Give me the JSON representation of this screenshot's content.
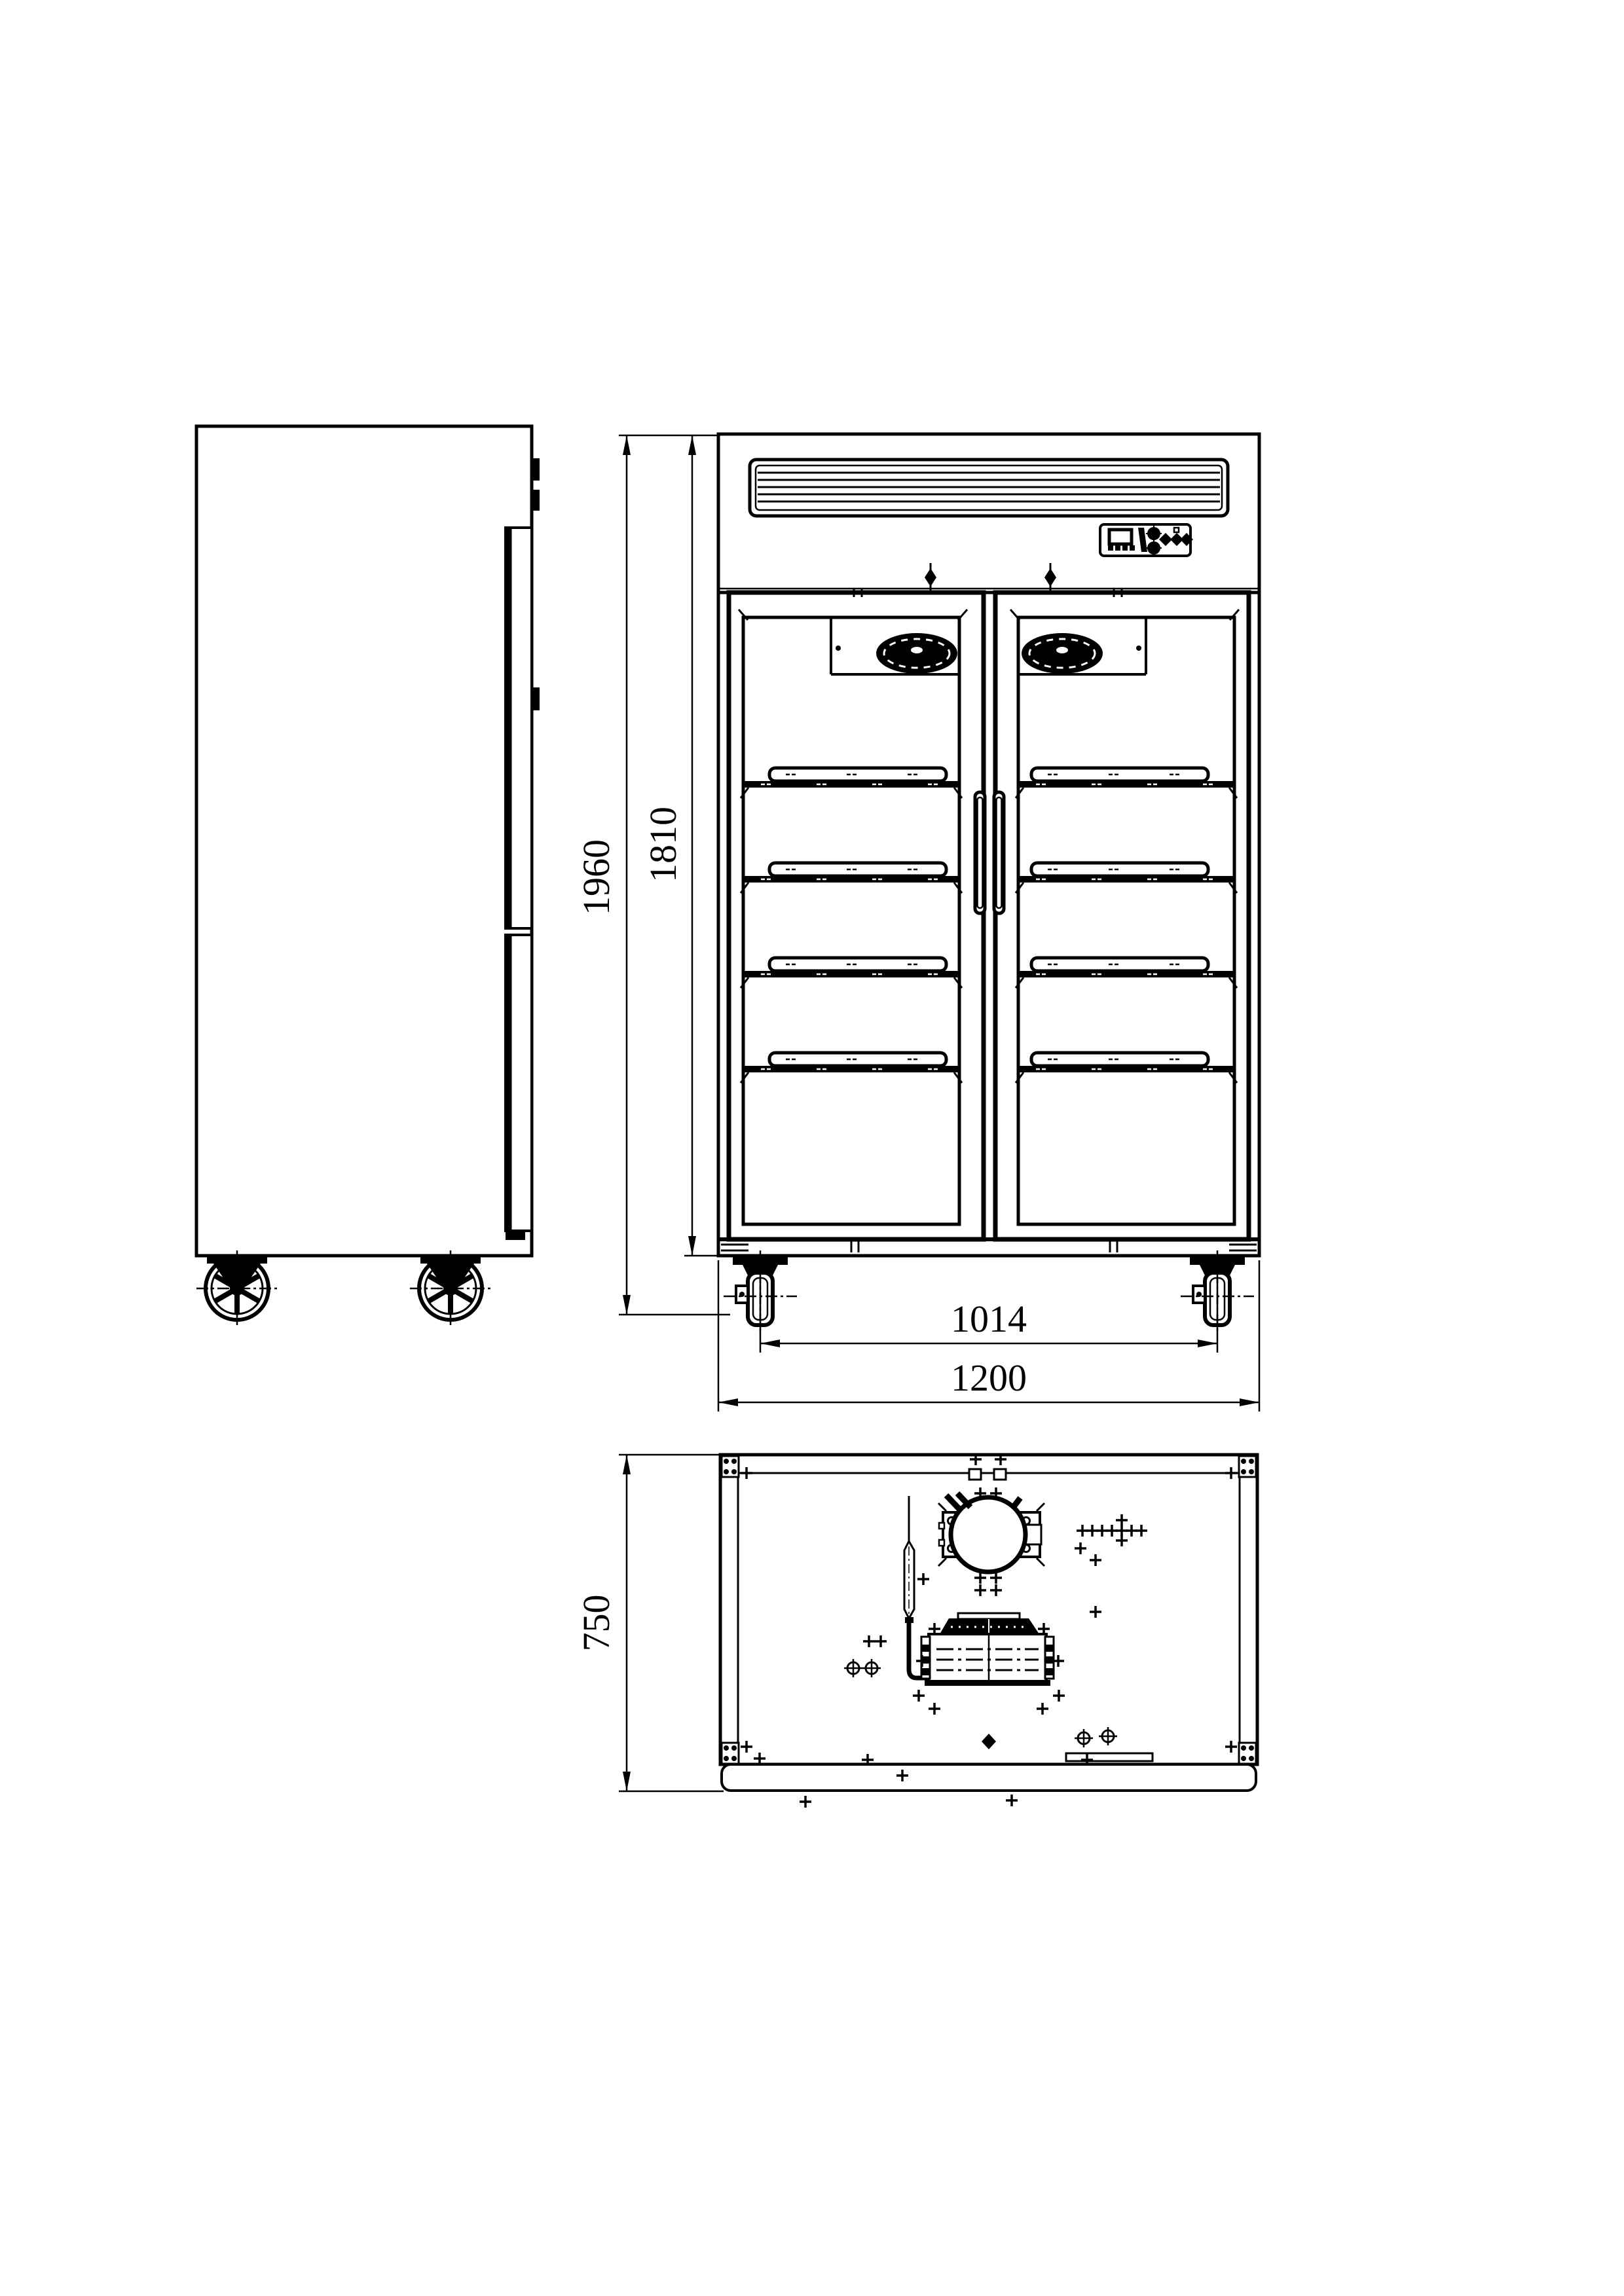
{
  "dimensions": {
    "overall_height": "1960",
    "body_height": "1810",
    "caster_spacing": "1014",
    "overall_width": "1200",
    "depth": "750"
  },
  "colors": {
    "line": "#000000",
    "background": "#ffffff"
  }
}
